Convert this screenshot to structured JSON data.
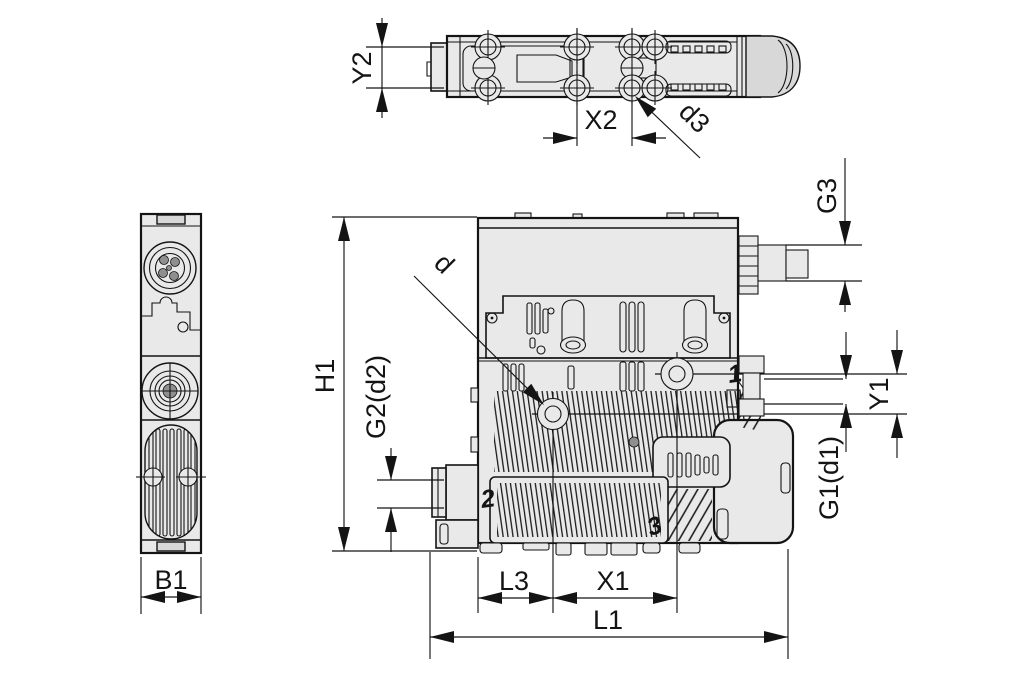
{
  "title": "vacuum-ejector-dimensional-drawing",
  "labels": {
    "y2": "Y2",
    "x2": "X2",
    "d3": "d3",
    "b1": "B1",
    "h1": "H1",
    "g2_d2": "G2(d2)",
    "d": "d",
    "g3": "G3",
    "y1": "Y1",
    "g1_d1": "G1(d1)",
    "l3": "L3",
    "x1": "X1",
    "l1": "L1"
  },
  "ports": {
    "port1": "1",
    "port2": "2",
    "port3": "3"
  },
  "colors": {
    "line": "#141414",
    "body": "#e9e9e9",
    "cap": "#d8d8d8",
    "dark": "#8f8f8f",
    "background": "#ffffff"
  }
}
